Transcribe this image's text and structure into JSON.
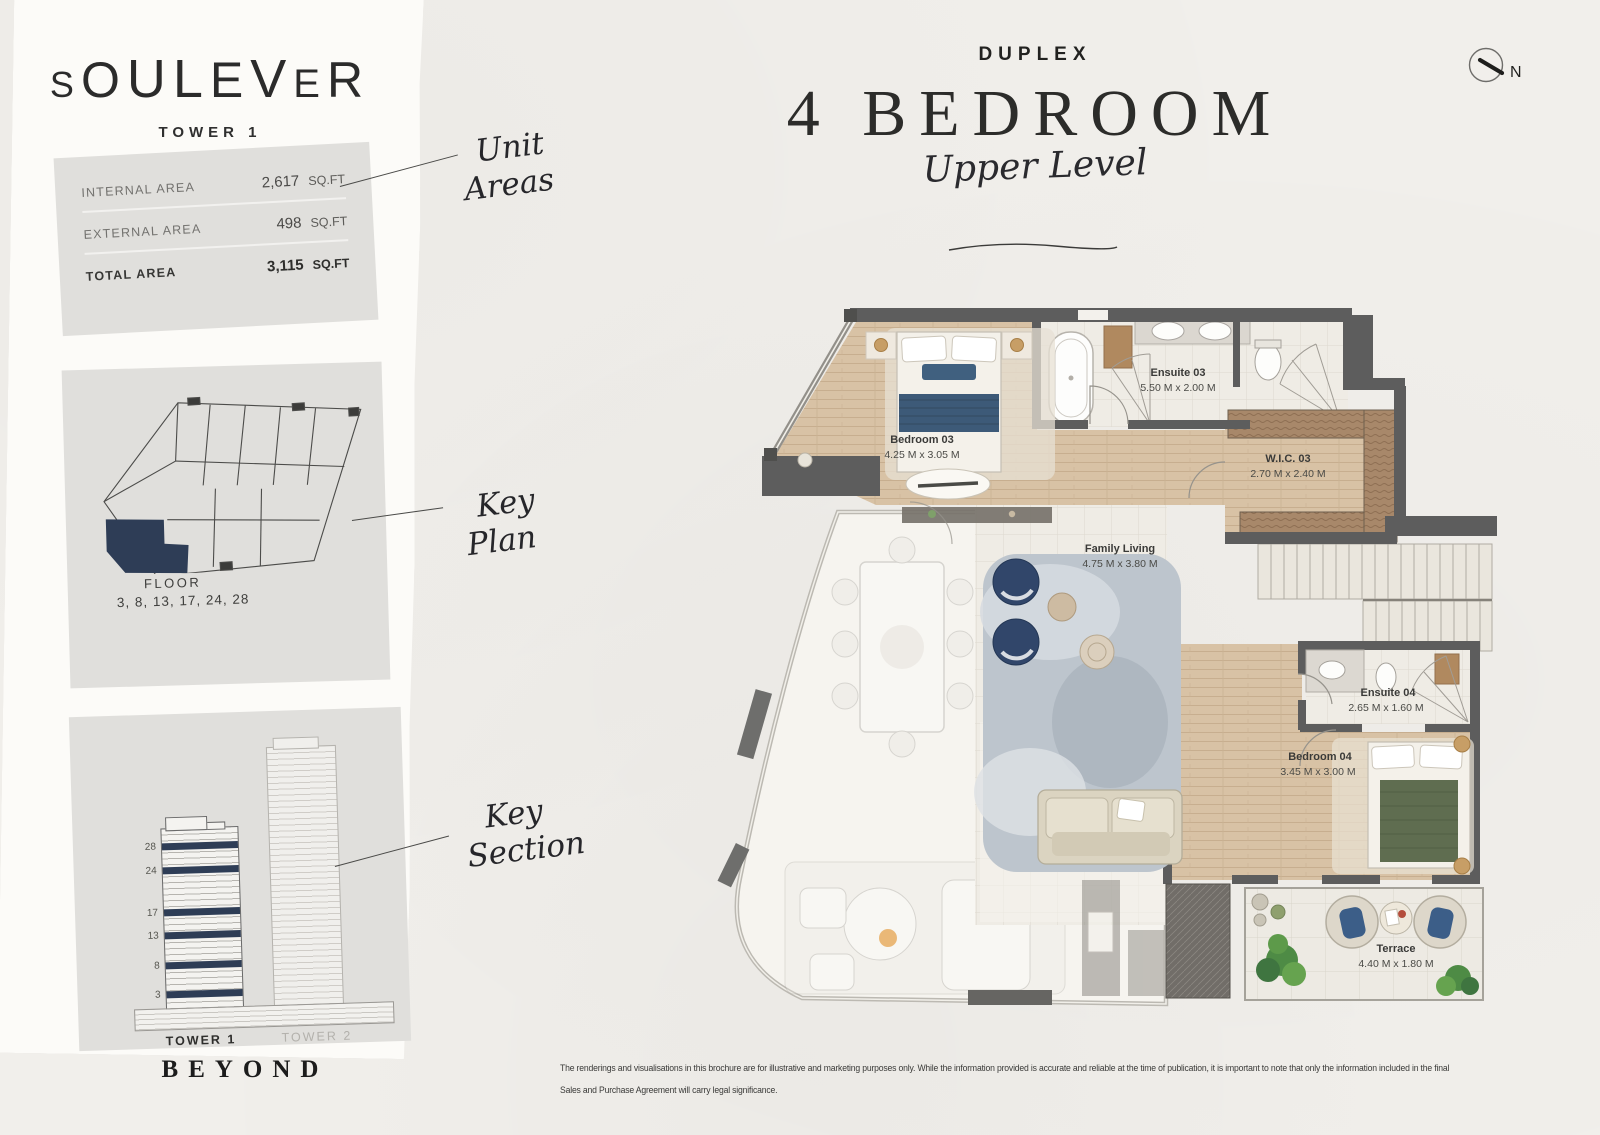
{
  "sidebar": {
    "brand": "SOULEVER",
    "tower": "TOWER 1",
    "unit_areas": {
      "rows": [
        {
          "label": "INTERNAL AREA",
          "value": "2,617",
          "unit": "SQ.FT"
        },
        {
          "label": "EXTERNAL AREA",
          "value": "498",
          "unit": "SQ.FT"
        },
        {
          "label": "TOTAL AREA",
          "value": "3,115",
          "unit": "SQ.FT"
        }
      ]
    },
    "key_plan": {
      "floor_label": "FLOOR",
      "floors": "3, 8, 13, 17, 24, 28"
    },
    "key_section": {
      "floor_marks": [
        "28",
        "24",
        "17",
        "13",
        "8",
        "3"
      ],
      "tower1_label": "TOWER 1",
      "tower2_label": "TOWER 2"
    },
    "footer_brand": "BEYOND"
  },
  "annotations": {
    "unit_areas": {
      "line1": "Unit",
      "line2": "Areas"
    },
    "key_plan": {
      "line1": "Key",
      "line2": "Plan"
    },
    "key_section": {
      "line1": "Key",
      "line2": "Section"
    }
  },
  "header": {
    "category": "DUPLEX",
    "title": "4 BEDROOM",
    "subtitle": "Upper Level",
    "north_label": "N"
  },
  "floorplan": {
    "rooms": [
      {
        "name": "Bedroom 03",
        "dims": "4.25 M x 3.05 M"
      },
      {
        "name": "Ensuite 03",
        "dims": "5.50 M x 2.00 M"
      },
      {
        "name": "W.I.C. 03",
        "dims": "2.70 M x 2.40 M"
      },
      {
        "name": "Family Living",
        "dims": "4.75 M x 3.80 M"
      },
      {
        "name": "Ensuite 04",
        "dims": "2.65 M x 1.60 M"
      },
      {
        "name": "Bedroom 04",
        "dims": "3.45 M x 3.00 M"
      },
      {
        "name": "Terrace",
        "dims": "4.40 M x 1.80 M"
      }
    ]
  },
  "disclaimer": {
    "line1": "The renderings and visualisations in this brochure are for illustrative and marketing purposes only. While the information provided is accurate and reliable at the time of publication, it is important to note that only the information included in the final",
    "line2": "Sales and Purchase Agreement will carry legal significance."
  },
  "colors": {
    "navy": "#2e3d56",
    "wall": "#5d5d5d",
    "wood": "#d8c2a5",
    "panel_grey": "#e0dfdc",
    "paper": "#f1efeb"
  }
}
